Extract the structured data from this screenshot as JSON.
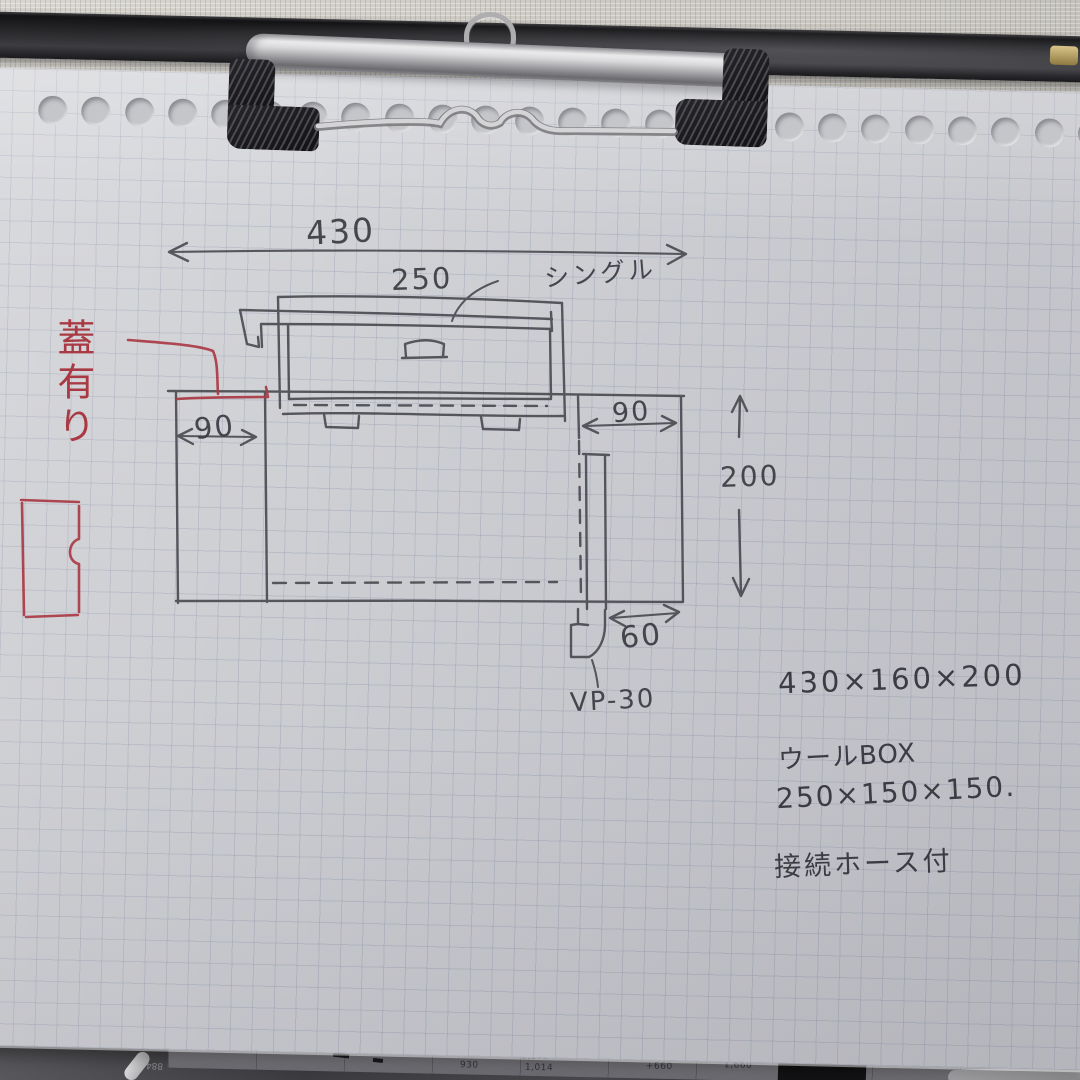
{
  "drawing": {
    "dimensions": {
      "overall_width": "430",
      "woolbox_width": "250",
      "left_section_width": "90",
      "right_section_width": "90",
      "tank_height": "200",
      "drain_offset": "60"
    },
    "annotations": {
      "faucet_type": "シングル",
      "lid_note": "蓋有り",
      "drain_pipe": "VP-30"
    },
    "spec_notes": {
      "line1": "430×160×200",
      "line2": "ウールBOX",
      "line3": "250×150×150.",
      "line4": "接続ホース付"
    }
  },
  "background_sheet": {
    "numbers": [
      "924",
      "930",
      "1,370",
      "1,014",
      "+660",
      "1,660"
    ],
    "faint_mark": "884"
  },
  "colors": {
    "pencil": "#45464c",
    "red_pen": "#a93a44",
    "paper": "#d2d3d7",
    "grid_line": "#8e96af",
    "clipboard": "#232326",
    "wall": "#ccc9c3"
  }
}
